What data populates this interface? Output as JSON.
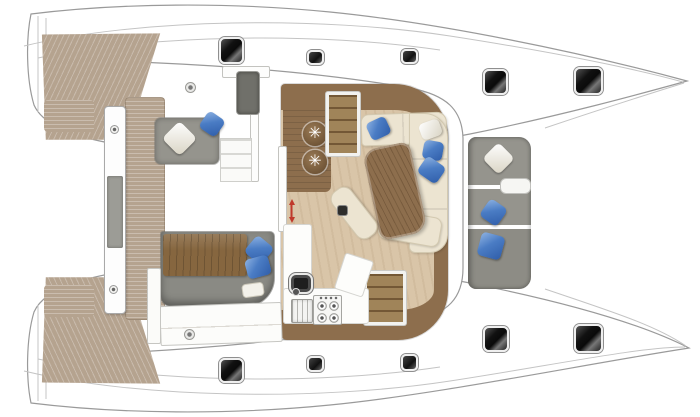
{
  "meta": {
    "title": "Catamaran interior layout floor plan (top view, bows to the right)",
    "canvas": {
      "width": 700,
      "height": 417
    }
  },
  "palette": {
    "hull-white": "#ffffff",
    "outline-gray": "#9a9a9a",
    "teak": "#b5a38f",
    "wood-dark": "#8d6e4d",
    "wood-mid": "#a08459",
    "floor-beige": "#d9c5a8",
    "cream": "#ece4d1",
    "seat-gray": "#95948d",
    "pillow-blue": "#4a7cc4",
    "hatch-dark": "#1c1c1c",
    "arrow-red": "#c0392b"
  },
  "items": [
    {
      "name": "aft-deck-teak-port",
      "type": "teak-wedge-top",
      "x": 38,
      "y": 30,
      "w": 130,
      "h": 112
    },
    {
      "name": "aft-deck-teak-starboard",
      "type": "teak-wedge-bottom",
      "x": 38,
      "y": 275,
      "w": 130,
      "h": 112
    },
    {
      "name": "transom-teak-step-port",
      "type": "teak-pad",
      "x": 44,
      "y": 100,
      "w": 50,
      "h": 32
    },
    {
      "name": "transom-teak-step-starboard",
      "type": "teak-pad",
      "x": 44,
      "y": 285,
      "w": 50,
      "h": 32
    },
    {
      "name": "aft-platform-teak",
      "type": "teak-strip",
      "x": 125,
      "y": 97,
      "w": 40,
      "h": 223
    },
    {
      "name": "davit-beam",
      "type": "davit-bar",
      "x": 104,
      "y": 106,
      "w": 22,
      "h": 208
    },
    {
      "name": "davit-panel",
      "type": "davit-panel",
      "x": 107,
      "y": 176,
      "w": 16,
      "h": 72
    },
    {
      "name": "davit-screw-top",
      "type": "screw",
      "x": 110,
      "y": 125,
      "w": 9,
      "h": 9
    },
    {
      "name": "davit-screw-bottom",
      "type": "screw",
      "x": 109,
      "y": 285,
      "w": 9,
      "h": 9
    },
    {
      "name": "saloon-floor",
      "type": "saloon-floor",
      "x": 281,
      "y": 84,
      "w": 167,
      "h": 256
    },
    {
      "name": "galley-wood-column",
      "type": "wood-column",
      "x": 283,
      "y": 110,
      "w": 48,
      "h": 82
    },
    {
      "name": "bar-stool-1",
      "type": "stool",
      "x": 303,
      "y": 122,
      "w": 24,
      "h": 24
    },
    {
      "name": "bar-stool-2",
      "type": "stool",
      "x": 303,
      "y": 150,
      "w": 24,
      "h": 24
    },
    {
      "name": "companionway-stairs-port",
      "type": "stairs-wood",
      "x": 326,
      "y": 92,
      "w": 34,
      "h": 64
    },
    {
      "name": "companionway-stairs-starboard",
      "type": "stairs-wood",
      "x": 364,
      "y": 271,
      "w": 42,
      "h": 54
    },
    {
      "name": "cockpit-bulkhead-wall",
      "type": "wall-white",
      "x": 250,
      "y": 68,
      "w": 9,
      "h": 114
    },
    {
      "name": "saloon-entry-door",
      "type": "wall-white",
      "x": 278,
      "y": 146,
      "w": 9,
      "h": 86
    },
    {
      "name": "cockpit-wall-top",
      "type": "wall-white",
      "x": 222,
      "y": 66,
      "w": 48,
      "h": 12
    },
    {
      "name": "galley-counter-side",
      "type": "counter-white",
      "x": 283,
      "y": 224,
      "w": 29,
      "h": 100
    },
    {
      "name": "galley-counter-aft",
      "type": "counter-white",
      "x": 283,
      "y": 288,
      "w": 86,
      "h": 36
    },
    {
      "name": "galley-counter-corner",
      "type": "counter-white",
      "x": 339,
      "y": 256,
      "w": 30,
      "h": 38,
      "rot": 18
    },
    {
      "name": "galley-sink",
      "type": "sink-dark",
      "x": 289,
      "y": 273,
      "w": 24,
      "h": 21
    },
    {
      "name": "galley-oven",
      "type": "oven",
      "x": 291,
      "y": 299,
      "w": 22,
      "h": 24
    },
    {
      "name": "galley-stove",
      "type": "stove",
      "x": 313,
      "y": 295,
      "w": 29,
      "h": 30
    },
    {
      "name": "cockpit-lounge-seat",
      "type": "seat-gray",
      "x": 155,
      "y": 118,
      "w": 64,
      "h": 46
    },
    {
      "name": "lounge-pillow-white",
      "type": "pillow-white",
      "x": 167,
      "y": 126,
      "w": 25,
      "h": 25,
      "rot": 45
    },
    {
      "name": "lounge-pillow-blue",
      "type": "pillow-blue",
      "x": 202,
      "y": 114,
      "w": 20,
      "h": 20,
      "rot": 35
    },
    {
      "name": "helm-console",
      "type": "console-dark",
      "x": 237,
      "y": 72,
      "w": 22,
      "h": 42
    },
    {
      "name": "deck-fitting-port",
      "type": "fitting-circle",
      "x": 185,
      "y": 82,
      "w": 11,
      "h": 11
    },
    {
      "name": "cockpit-steps",
      "type": "steps-white",
      "x": 220,
      "y": 138,
      "w": 32,
      "h": 44
    },
    {
      "name": "cockpit-daybed-base",
      "type": "daybed-base",
      "x": 161,
      "y": 232,
      "w": 113,
      "h": 74
    },
    {
      "name": "daybed-wood-mattress",
      "type": "blanket-wood",
      "x": 163,
      "y": 234,
      "w": 84,
      "h": 42
    },
    {
      "name": "daybed-pillow-blue-1",
      "type": "pillow-blue",
      "x": 248,
      "y": 239,
      "w": 22,
      "h": 22,
      "rot": 40
    },
    {
      "name": "daybed-pillow-blue-2",
      "type": "pillow-blue",
      "x": 246,
      "y": 257,
      "w": 24,
      "h": 20,
      "rot": -15
    },
    {
      "name": "daybed-pillow-white",
      "type": "pillow-white-flat",
      "x": 242,
      "y": 283,
      "w": 22,
      "h": 14,
      "rot": -8
    },
    {
      "name": "aft-cabinet",
      "type": "cabinet-row",
      "x": 160,
      "y": 304,
      "w": 122,
      "h": 40,
      "rot": -2
    },
    {
      "name": "deck-fitting-starboard",
      "type": "fitting-circle",
      "x": 184,
      "y": 329,
      "w": 11,
      "h": 11
    },
    {
      "name": "wardrobe-locker",
      "type": "wardrobe",
      "x": 147,
      "y": 268,
      "w": 14,
      "h": 76
    },
    {
      "name": "foredeck-lounge-seat",
      "type": "seat-fwd",
      "x": 468,
      "y": 137,
      "w": 63,
      "h": 152
    },
    {
      "name": "foredeck-pillow-white",
      "type": "pillow-white",
      "x": 487,
      "y": 147,
      "w": 23,
      "h": 23,
      "rot": 45
    },
    {
      "name": "foredeck-pillow-blue-1",
      "type": "pillow-blue",
      "x": 483,
      "y": 202,
      "w": 21,
      "h": 21,
      "rot": 35
    },
    {
      "name": "foredeck-pillow-blue-2",
      "type": "pillow-blue",
      "x": 479,
      "y": 234,
      "w": 24,
      "h": 24,
      "rot": 15
    },
    {
      "name": "foredeck-side-table",
      "type": "fwd-table",
      "x": 500,
      "y": 178,
      "w": 31,
      "h": 16
    },
    {
      "name": "saloon-sofa-forward",
      "type": "sofa sofa-top",
      "x": 361,
      "y": 113,
      "w": 86,
      "h": 32,
      "rot": -2
    },
    {
      "name": "saloon-sofa-side",
      "type": "sofa sofa-right",
      "x": 409,
      "y": 113,
      "w": 39,
      "h": 140
    },
    {
      "name": "saloon-sofa-aft",
      "type": "sofa sofa-bottom",
      "x": 379,
      "y": 213,
      "w": 62,
      "h": 30,
      "rot": 10
    },
    {
      "name": "saloon-dining-table",
      "type": "table-wood",
      "x": 371,
      "y": 145,
      "w": 48,
      "h": 92,
      "rot": -12
    },
    {
      "name": "saloon-chaise-bench",
      "type": "chaise",
      "x": 342,
      "y": 184,
      "w": 24,
      "h": 58,
      "rot": -38
    },
    {
      "name": "floor-hatch-box",
      "type": "floor-box",
      "x": 338,
      "y": 206,
      "w": 9,
      "h": 9
    },
    {
      "name": "door-direction-arrow",
      "type": "arrow-red",
      "x": 288,
      "y": 197,
      "w": 7,
      "h": 28
    },
    {
      "name": "sofa-pillow-blue-1",
      "type": "pillow-blue",
      "x": 368,
      "y": 119,
      "w": 21,
      "h": 19,
      "rot": -25
    },
    {
      "name": "sofa-pillow-white",
      "type": "pillow-white",
      "x": 420,
      "y": 121,
      "w": 21,
      "h": 17,
      "rot": -20
    },
    {
      "name": "sofa-pillow-blue-2",
      "type": "pillow-blue",
      "x": 423,
      "y": 141,
      "w": 20,
      "h": 19,
      "rot": 10
    },
    {
      "name": "sofa-pillow-blue-3",
      "type": "pillow-blue",
      "x": 420,
      "y": 160,
      "w": 23,
      "h": 20,
      "rot": 35
    },
    {
      "name": "deck-hatch-port-aft",
      "type": "hatch-lg",
      "x": 219,
      "y": 37,
      "w": 25,
      "h": 27
    },
    {
      "name": "skylight-port-mid",
      "type": "hatch-sm",
      "x": 307,
      "y": 50,
      "w": 17,
      "h": 15
    },
    {
      "name": "skylight-port-fwd",
      "type": "hatch-sm",
      "x": 401,
      "y": 49,
      "w": 17,
      "h": 15
    },
    {
      "name": "deck-hatch-port-bow-1",
      "type": "hatch-lg",
      "x": 483,
      "y": 69,
      "w": 25,
      "h": 26
    },
    {
      "name": "deck-hatch-port-bow-2",
      "type": "hatch-lg",
      "x": 574,
      "y": 67,
      "w": 29,
      "h": 28
    },
    {
      "name": "deck-hatch-stbd-aft",
      "type": "hatch-lg",
      "x": 219,
      "y": 358,
      "w": 25,
      "h": 25
    },
    {
      "name": "skylight-stbd-mid",
      "type": "hatch-sm",
      "x": 307,
      "y": 356,
      "w": 17,
      "h": 16
    },
    {
      "name": "skylight-stbd-fwd",
      "type": "hatch-sm",
      "x": 401,
      "y": 354,
      "w": 17,
      "h": 17
    },
    {
      "name": "deck-hatch-stbd-bow-1",
      "type": "hatch-lg",
      "x": 483,
      "y": 326,
      "w": 26,
      "h": 26
    },
    {
      "name": "deck-hatch-stbd-bow-2",
      "type": "hatch-lg",
      "x": 574,
      "y": 324,
      "w": 29,
      "h": 29
    }
  ]
}
